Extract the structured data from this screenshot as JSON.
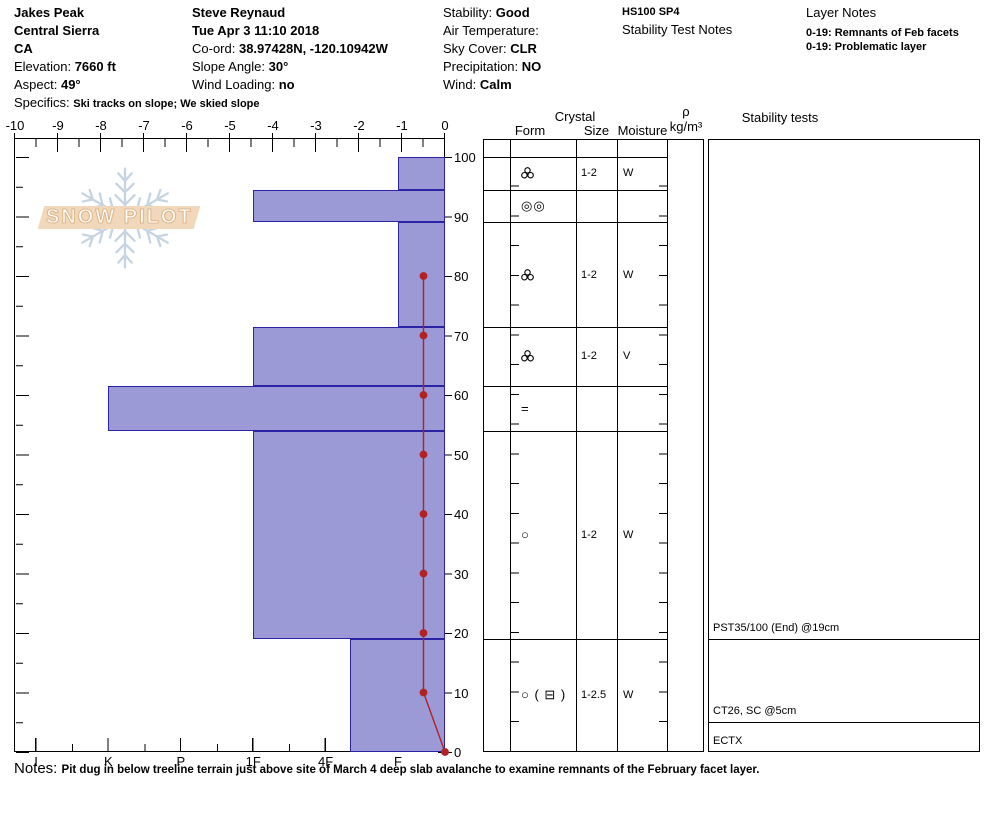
{
  "header": {
    "site": {
      "name": "Jakes Peak",
      "area": "Central Sierra",
      "state": "CA",
      "elevation_label": "Elevation: ",
      "elevation": "7660 ft",
      "aspect_label": "Aspect: ",
      "aspect": "49°",
      "specifics_label": "Specifics: ",
      "specifics": "Ski tracks on slope; We skied slope"
    },
    "observer": {
      "name": "Steve Reynaud",
      "datetime": "Tue Apr 3 11:10 2018",
      "coord_label": "Co-ord: ",
      "coord": "38.97428N, -120.10942W",
      "slope_angle_label": "Slope Angle: ",
      "slope_angle": "30°",
      "wind_loading_label": "Wind Loading: ",
      "wind_loading": "no"
    },
    "conditions": {
      "stability_label": "Stability: ",
      "stability": "Good",
      "air_temp_label": "Air Temperature:",
      "sky_label": "Sky Cover: ",
      "sky": "CLR",
      "precip_label": "Precipitation: ",
      "precip": "NO",
      "wind_label": "Wind: ",
      "wind": "Calm"
    },
    "summary": {
      "code": "HS100 SP4",
      "stability_test_notes_title": "Stability Test Notes"
    },
    "layer_notes": {
      "title": "Layer Notes",
      "items": [
        "0-19: Remnants of Feb facets",
        "0-19: Problematic layer"
      ]
    }
  },
  "watermark": {
    "text": "SNOW PILOT"
  },
  "table_headers": {
    "crystal": "Crystal",
    "form": "Form",
    "size": "Size",
    "moisture": "Moisture",
    "density_symbol": "ρ",
    "density_units": "kg/m³",
    "stability": "Stability tests"
  },
  "notes": {
    "label": "Notes: ",
    "text": "Pit dug in below treeline terrain just above site of March 4 deep slab avalanche to examine remnants of the February facet layer."
  },
  "chart_data": {
    "type": "snow-profile",
    "title": "Snow pit hardness / temperature profile",
    "temp_axis": {
      "ticks": [
        -10,
        -9,
        -8,
        -7,
        -6,
        -5,
        -4,
        -3,
        -2,
        -1,
        0
      ],
      "range": [
        -10,
        0
      ],
      "units": "°C"
    },
    "depth_axis": {
      "ticks": [
        100,
        90,
        80,
        70,
        60,
        50,
        40,
        30,
        20,
        10,
        0
      ],
      "range": [
        0,
        100
      ],
      "units": "cm"
    },
    "hardness_axis": {
      "categories": [
        "I",
        "K",
        "P",
        "1F",
        "4F",
        "F"
      ]
    },
    "layers": [
      {
        "top": 100,
        "bottom": 94.5,
        "hardness": "F",
        "form": {
          "kind": "svg",
          "name": "mf-cluster-icon"
        },
        "size": "1-2",
        "moisture": "W"
      },
      {
        "top": 94.5,
        "bottom": 89,
        "hardness": "1F",
        "form": {
          "kind": "text",
          "value": "◎◎"
        },
        "size": "",
        "moisture": ""
      },
      {
        "top": 89,
        "bottom": 71.5,
        "hardness": "F",
        "form": {
          "kind": "svg",
          "name": "mf-cluster-icon"
        },
        "size": "1-2",
        "moisture": "W"
      },
      {
        "top": 71.5,
        "bottom": 61.5,
        "hardness": "1F",
        "form": {
          "kind": "svg",
          "name": "mf-cluster-icon"
        },
        "size": "1-2",
        "moisture": "V"
      },
      {
        "top": 61.5,
        "bottom": 54,
        "hardness": "K",
        "form": {
          "kind": "text",
          "value": "="
        },
        "size": "",
        "moisture": ""
      },
      {
        "top": 54,
        "bottom": 19,
        "hardness": "1F",
        "form": {
          "kind": "text",
          "value": "○"
        },
        "size": "1-2",
        "moisture": "W"
      },
      {
        "top": 19,
        "bottom": 0,
        "hardness": "4F-",
        "form": {
          "kind": "text",
          "value": "○ ( ⊟ )"
        },
        "size": "1-2.5",
        "moisture": "W"
      }
    ],
    "temperature_profile": [
      {
        "depth": 80,
        "temp": -0.5
      },
      {
        "depth": 70,
        "temp": -0.5
      },
      {
        "depth": 60,
        "temp": -0.5
      },
      {
        "depth": 50,
        "temp": -0.5
      },
      {
        "depth": 40,
        "temp": -0.5
      },
      {
        "depth": 30,
        "temp": -0.5
      },
      {
        "depth": 20,
        "temp": -0.5
      },
      {
        "depth": 10,
        "temp": -0.5
      },
      {
        "depth": 0,
        "temp": 0
      }
    ],
    "stability_tests": [
      {
        "text": "PST35/100 (End) @19cm",
        "line_depth": 19
      },
      {
        "text": "CT26, SC @5cm",
        "line_depth": 5
      },
      {
        "text": "ECTX",
        "line_depth": 0
      }
    ],
    "colors": {
      "bar_fill": "#9b99d6",
      "bar_border": "#2a23a6",
      "temp_line": "#b22222"
    }
  }
}
